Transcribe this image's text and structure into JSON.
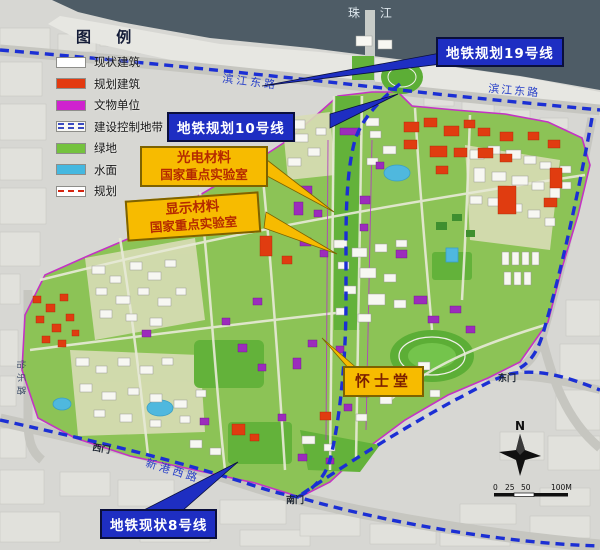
{
  "legend": {
    "title": "图 例",
    "items": [
      {
        "label": "现状建筑",
        "color": "#ffffff"
      },
      {
        "label": "规划建筑",
        "color": "#e33a10"
      },
      {
        "label": "文物单位",
        "color": "#cf22cf"
      },
      {
        "label": "建设控制地带",
        "color": "#f7f7f3"
      },
      {
        "label": "绿地",
        "color": "#74c23e"
      },
      {
        "label": "水面",
        "color": "#45b8e0"
      },
      {
        "label": "规划",
        "color": "#ffffff"
      }
    ]
  },
  "callouts": {
    "metro19": {
      "label": "地铁规划19号线",
      "bg": "#1e2ec2",
      "text": "#ffffff"
    },
    "metro10": {
      "label": "地铁规划10号线",
      "bg": "#1e2ec2",
      "text": "#ffffff"
    },
    "metro8": {
      "label": "地铁现状8号线",
      "bg": "#1e2ec2",
      "text": "#ffffff"
    },
    "opto_lab": {
      "line1": "光电材料",
      "line2": "国家重点实验室",
      "bg": "#f7bb00",
      "text": "#b52a00"
    },
    "display_lab": {
      "line1": "显示材料",
      "line2": "国家重点实验室",
      "bg": "#f7bb00",
      "text": "#b52a00"
    },
    "swasey_hall": {
      "label": "怀士堂",
      "bg": "#f7bb00",
      "text": "#7c1f00"
    }
  },
  "map_labels": {
    "river": "珠  江",
    "binjiang_east_1": "滨江东路",
    "binjiang_east_2": "滨江东路",
    "xingang_west": "新港西路",
    "yile_road": "怡乐路",
    "west_gate": "西门",
    "south_gate": "南门",
    "east_gate": "东门"
  },
  "compass": {
    "north": "N"
  },
  "scale_bar": {
    "t0": "0",
    "t25": "25",
    "t50": "50",
    "t100": "100M"
  },
  "colors": {
    "metro_line": "#1b2fd4",
    "river_water": "#4e5c66",
    "campus_green": "#8cc356",
    "boundary_magenta": "#c433c4",
    "road_gray": "#c6c6c0"
  }
}
